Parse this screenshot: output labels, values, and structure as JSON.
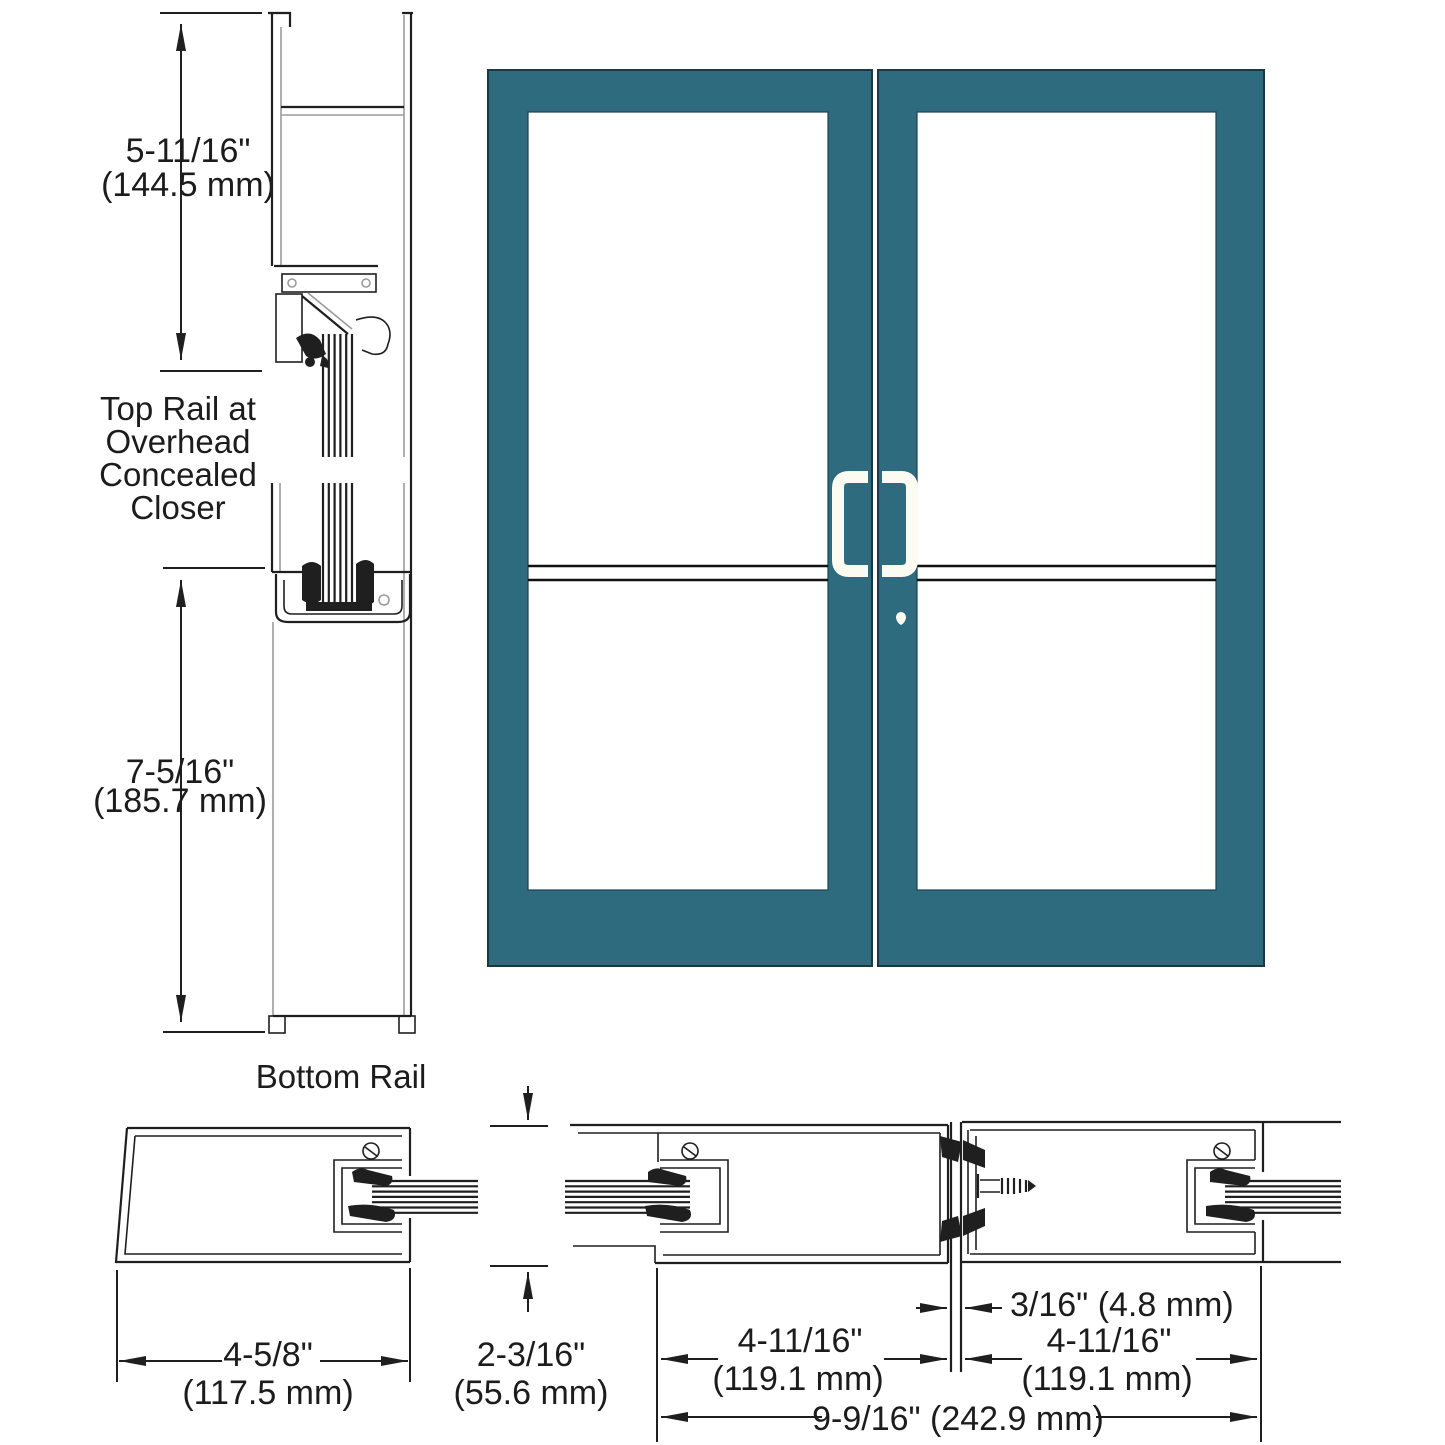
{
  "title": "Door pair elevation with rail and stile section details",
  "colors": {
    "door": "#2e6b7e",
    "door_edge": "#1a3844",
    "line_art": "#1f1f1f",
    "handle": "#fbfbf2",
    "glass": "#ffffff"
  },
  "vertical_section": {
    "top_dim": {
      "inches": "5-11/16\"",
      "mm": "(144.5 mm)"
    },
    "top_label": {
      "line1": "Top Rail at",
      "line2": "Overhead",
      "line3": "Concealed",
      "line4": "Closer"
    },
    "bottom_dim": {
      "inches": "7-5/16\"",
      "mm": "(185.7 mm)"
    },
    "bottom_label": "Bottom Rail"
  },
  "sections": {
    "hinge_stile": {
      "inches": "4-5/8\"",
      "mm": "(117.5 mm)"
    },
    "thickness": {
      "inches": "2-3/16\"",
      "mm": "(55.6 mm)"
    },
    "gap": "3/16\" (4.8 mm)",
    "lock_stile_left": {
      "inches": "4-11/16\"",
      "mm": "(119.1 mm)"
    },
    "lock_stile_right": {
      "inches": "4-11/16\"",
      "mm": "(119.1 mm)"
    },
    "overall": "9-9/16\" (242.9 mm)"
  }
}
